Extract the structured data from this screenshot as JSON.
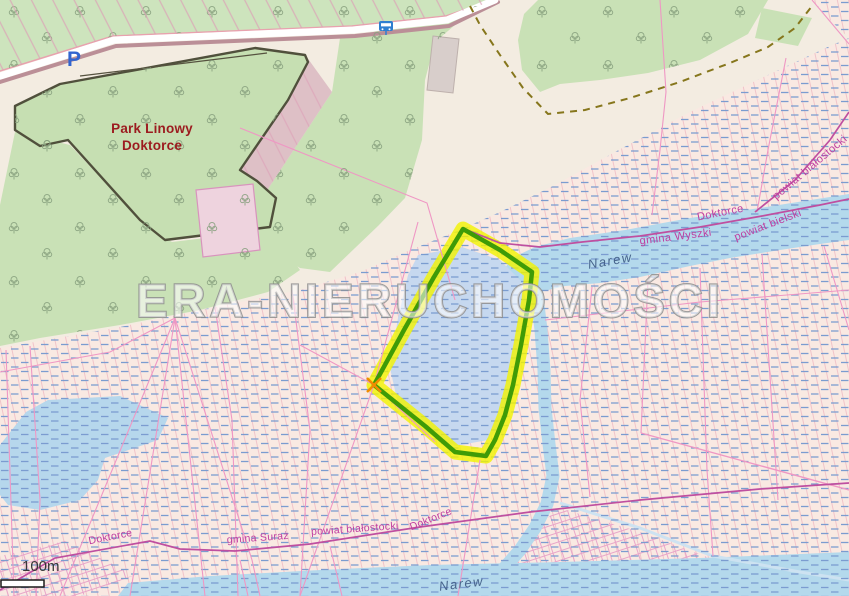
{
  "watermark": "ERA-NIERUCHOMOŚCI",
  "scale": {
    "label": "100m"
  },
  "poi": {
    "park_name_line1": "Park Linowy",
    "park_name_line2": "Doktorce",
    "parking_symbol": "P"
  },
  "admin_labels": {
    "upper_doktorce": "Doktorce",
    "upper_powiat_bielski": "powiat bielski",
    "upper_gmina_wyszki": "gmina Wyszki",
    "ne_powiat_bialostocki": "powiat białostocki",
    "lower_doktorce_west": "Doktorce",
    "lower_gmina_suraz": "gmina Suraż",
    "lower_powiat_bialostocki": "powiat białostocki",
    "lower_doktorce_east": "Doktorce"
  },
  "water_labels": {
    "narew_upper": "Narew",
    "narew_lower": "Narew"
  },
  "colors": {
    "base_beige": "#f3ece1",
    "forest_green": "#c9e1b6",
    "park_green": "#c6dfb2",
    "park_outline": "#50503c",
    "wetland_pink": "#f9e9e2",
    "hatch_pink": "#f0c3c9",
    "water_blue": "#b4d9ec",
    "pond_blue": "#c6d8ef",
    "dash_blue": "#7b9cd0",
    "highlight_yellow": "#f2f400",
    "plot_outline_green": "#3f9b07",
    "marker_orange": "#f08c00",
    "parcel_pink": "#ef97c4",
    "boundary_magenta": "#bf4fa0",
    "label_magenta": "#bf3da0",
    "river_label_blue": "#46638b",
    "park_label_red": "#9c1b1f",
    "parking_blue": "#3265cf",
    "road_casing": "#bb8f97",
    "path_dash_olive": "#86761c",
    "watermark_stroke": "#8d8d8d",
    "scale_text": "#383838"
  }
}
